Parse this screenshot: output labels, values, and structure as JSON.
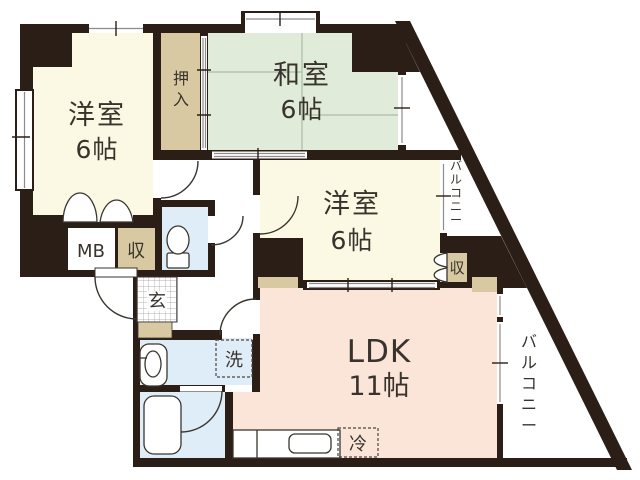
{
  "plan": {
    "rooms": {
      "western1": {
        "name": "洋室",
        "size": "6帖"
      },
      "japanese": {
        "name": "和室",
        "size": "6帖"
      },
      "western2": {
        "name": "洋室",
        "size": "6帖"
      },
      "ldk": {
        "name": "LDK",
        "size": "11帖"
      }
    },
    "labels": {
      "oshiire": "押入",
      "meter_box": "MB",
      "storage_hall": "収",
      "storage_western2": "収",
      "entrance": "玄",
      "washer": "洗",
      "fridge": "冷",
      "balcony_upper": "バルコニー",
      "balcony_right": "バルコニー"
    },
    "colors": {
      "wall": "#2B1E16",
      "western_room": "#FBF8E3",
      "japanese_room": "#E0EBD9",
      "ldk": "#FAE5D8",
      "closet": "#D8C9A2",
      "sanitary": "#DFEDF8",
      "fixture_line": "#3A362F",
      "window_gray": "#8C8C8C",
      "tatami_line": "#A9BCA4",
      "white": "#FFFFFF"
    }
  }
}
